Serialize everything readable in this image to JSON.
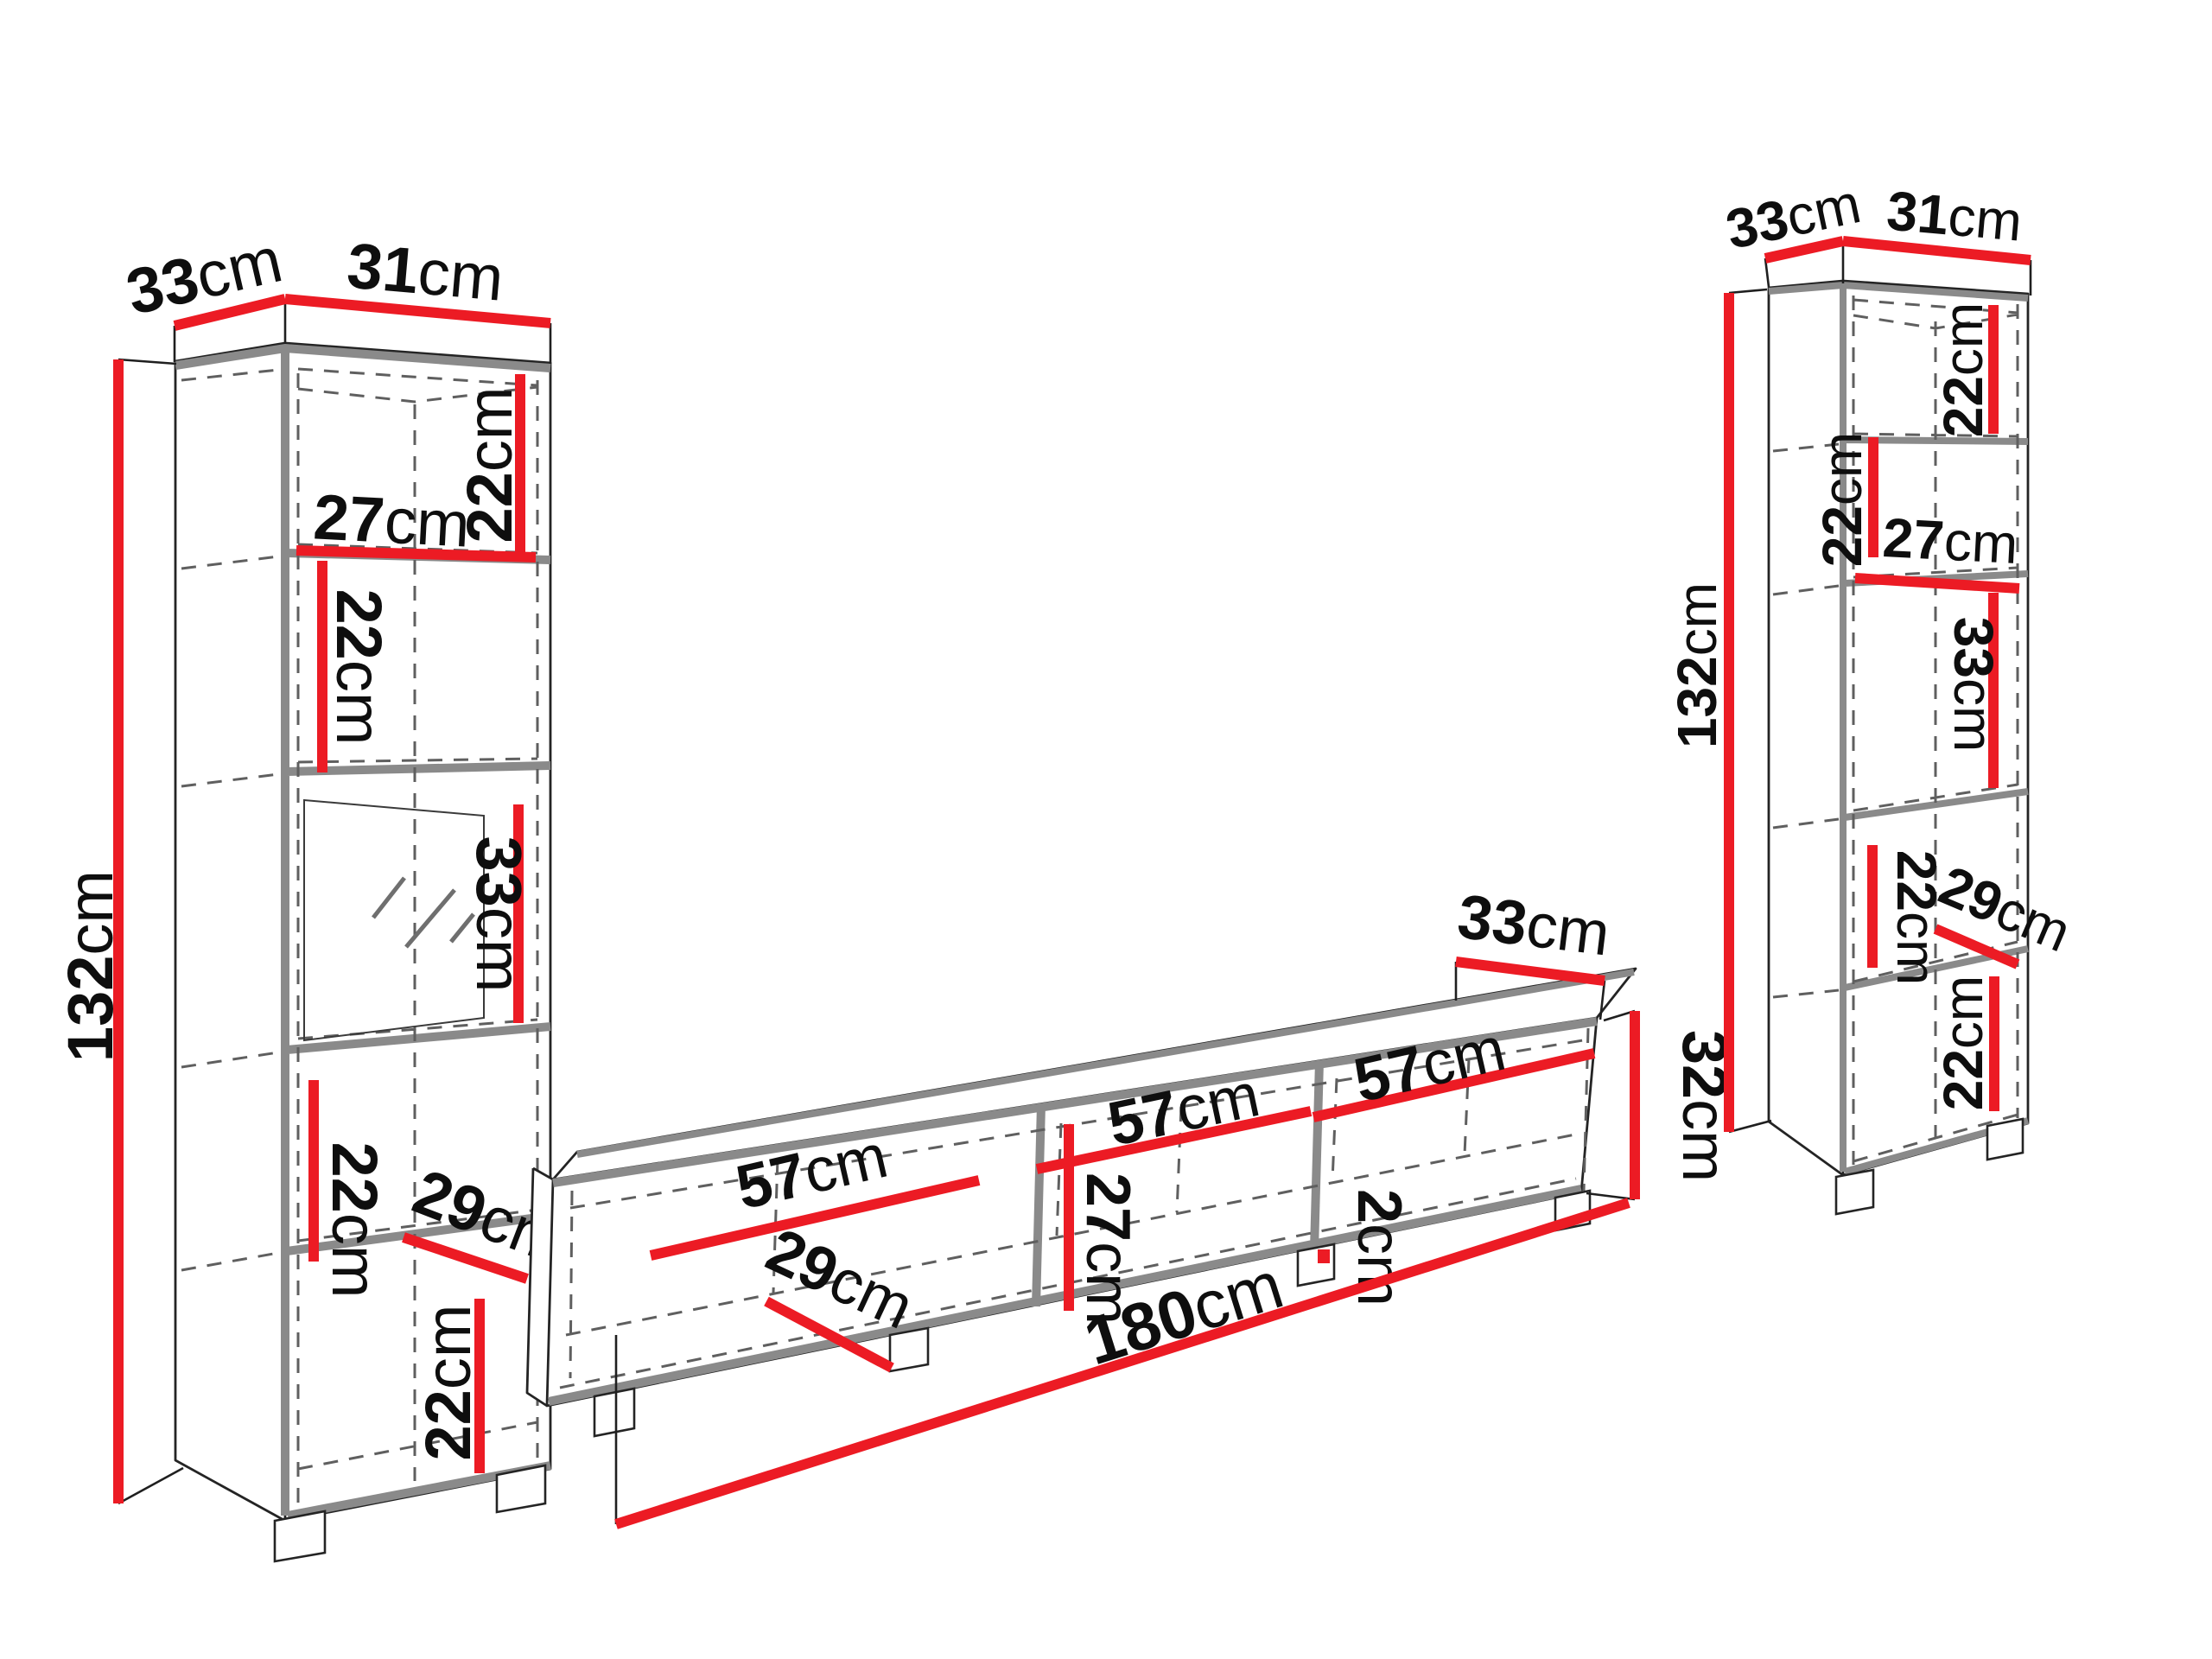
{
  "unit": "cm",
  "colors": {
    "dimension_red": "#ec1b24",
    "panel_gray": "#8a8a8a",
    "outline_black": "#1f1f1f",
    "hidden_line_gray": "#5f5f5f",
    "label_text": "#0e0e0e"
  },
  "left_cabinet": {
    "top_depth": "33",
    "top_width": "31",
    "height": "132",
    "section_1_height": "22",
    "shelf_width": "27",
    "section_2_height": "22",
    "section_3_height": "33",
    "section_4_height": "22",
    "inner_depth": "29",
    "section_5_height": "22",
    "unit": "cm"
  },
  "tv_stand": {
    "top_depth": "33",
    "height": "32",
    "compartment_1_width": "57",
    "compartment_2_width": "57",
    "compartment_3_width": "57",
    "inner_height": "27",
    "divider_thickness": "2",
    "inner_depth": "29",
    "total_width": "180",
    "unit": "cm"
  },
  "right_cabinet": {
    "top_depth": "33",
    "top_width": "31",
    "height": "132",
    "section_1_height": "22",
    "section_2_height": "22",
    "shelf_width": "27",
    "section_3_height": "33",
    "section_4_height": "22",
    "inner_depth": "29",
    "section_5_height": "22",
    "unit": "cm"
  }
}
